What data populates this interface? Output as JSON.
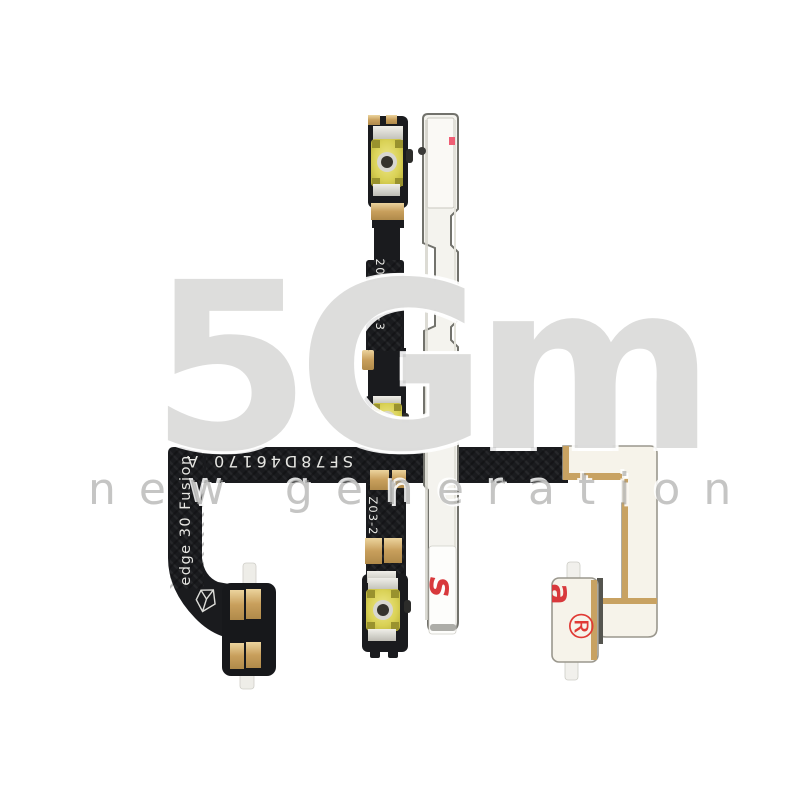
{
  "photo": {
    "flex_cable": {
      "model_marking": "edge 30 Fusion",
      "serial_marking": "SF78D46170_A",
      "date_marking": "20110-9-3",
      "batch_marking": "Z03-2"
    },
    "metal_bracket": {
      "sticker_print": "asc"
    },
    "end_bracket": {
      "print_letter": "a",
      "registered_symbol": "®"
    },
    "colors": {
      "flex_black": "#1a1b1e",
      "contact_gold": "#c89f5c",
      "button_membrane": "#d9d155",
      "bracket_face": "#f4f3ee",
      "cream_face": "#f6f3ea",
      "accent_red": "#e03a35",
      "watermark_gray": "#aaaaa8"
    }
  },
  "watermark": {
    "logo": "5Gm",
    "tagline": "new generation"
  }
}
